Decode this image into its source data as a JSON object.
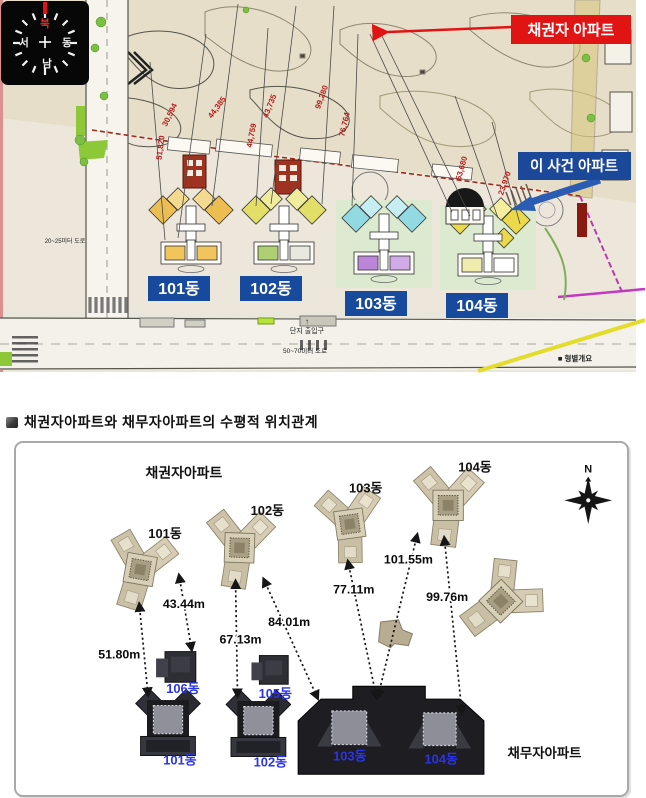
{
  "map": {
    "compass": {
      "north": "북",
      "east": "동",
      "south": "남",
      "west": "서"
    },
    "creditor_banner": "채권자 아파트",
    "case_banner": "이 사건 아파트",
    "building_labels": [
      "101동",
      "102동",
      "103동",
      "104동"
    ],
    "measurements": [
      "30,594",
      "51,820",
      "44,385",
      "44,759",
      "43,735",
      "99,280",
      "76,764",
      "53,680",
      "23,970"
    ],
    "entrance_text": "단지 출입구",
    "entrance_arrow": "↑",
    "road_bottom_text": "50~70미터 도로",
    "road_left_text": "20~25미터 도로",
    "legend_text": "■ 형별개요",
    "colors": {
      "banner_red": "#e11414",
      "banner_blue": "#1c4899",
      "measure_red": "#b31d1d"
    }
  },
  "diagram": {
    "title": "채권자아파트와 채무자아파트의 수평적 위치관계",
    "creditor_title": "채권자아파트",
    "debtor_title": "채무자아파트",
    "compass_n": "N",
    "creditor_buildings": [
      "101동",
      "102동",
      "103동",
      "104동"
    ],
    "debtor_buildings": [
      "101동",
      "102동",
      "103동",
      "104동",
      "105동",
      "106동"
    ],
    "distances": [
      {
        "value": "51.80m",
        "from": "채권자 101동",
        "to": "채무자 101동"
      },
      {
        "value": "43.44m",
        "from": "채권자 101동",
        "to": "채무자 106동"
      },
      {
        "value": "67.13m",
        "from": "채권자 102동",
        "to": "채무자 102동"
      },
      {
        "value": "84.01m",
        "from": "채권자 102동",
        "to": "채무자 103동"
      },
      {
        "value": "77.11m",
        "from": "채권자 103동",
        "to": "채무자 103동"
      },
      {
        "value": "101.55m",
        "from": "채권자 104동",
        "to": "채무자 103동"
      },
      {
        "value": "99.76m",
        "from": "채권자 104동",
        "to": "채무자 104동"
      }
    ]
  }
}
